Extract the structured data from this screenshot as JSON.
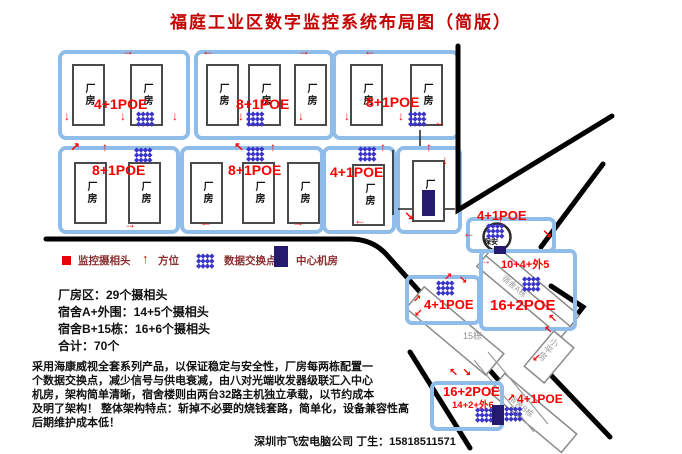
{
  "title": "福庭工业区数字监控系统布局图（简版）",
  "factory": {
    "building_label": "厂房",
    "blocks": [
      {
        "label": "4+1POE"
      },
      {
        "label": "8+1POE"
      },
      {
        "label": "8+1POE"
      },
      {
        "label": "8+1POE"
      },
      {
        "label": "8+1POE"
      },
      {
        "label": "4+1POE"
      }
    ]
  },
  "legend": {
    "camera": "监控摄相头",
    "direction": "方位",
    "switch": "数据交换点",
    "server_room": "中心机房"
  },
  "stats": {
    "lines": [
      "厂房区：29个摄相头",
      "宿舍A+外围：14+5个摄相头",
      "宿舍B+15栋：16+6个摄相头",
      "合计：70个"
    ]
  },
  "description": {
    "lines": [
      "采用海康威视全套系列产品，以保证稳定与安全性，厂房每两栋配置一",
      "个数据交换点，减少信号与供电衰减，由八对光端收发器级联汇入中心",
      "机房，架构简单清晰，宿舍楼则由两台32路主机独立承载，以节约成本",
      "及明了架构！ 整体架构特点：斩掉不必要的烧钱套路，简单化，设备兼容性高",
      "后期维护成本低！"
    ]
  },
  "contact": "深圳市飞宏电脑公司 丁生：15818511571",
  "site": {
    "security": {
      "poe": "4+1POE",
      "label": "保安"
    },
    "dorm_a": {
      "counts": "10+4+外5",
      "poe": "16+2POE",
      "label": "宿舍A栋"
    },
    "block15": {
      "poe": "4+1POE",
      "label": "15栋"
    },
    "dorm_b": {
      "poe": "16+2POE",
      "counts": "14+2+外6",
      "poe2": "4+1POE",
      "label": "宿舍B栋"
    },
    "bungalow": {
      "label": "小平房"
    }
  },
  "icons": {
    "diamond_row": "◆◆◆◆",
    "arrow_up": "↑",
    "arrow_down": "↓",
    "arrow_left": "←",
    "arrow_right": "→",
    "arrow_up_right": "↗",
    "arrow_down_right": "↘",
    "arrow_up_left": "↖",
    "arrow_down_left": "↙"
  },
  "colors": {
    "title_red": "#c40000",
    "poe_red": "#fb0000",
    "switch_blue": "#3a35c8",
    "box_blue": "#8fbce8",
    "room_navy": "#241a70",
    "legend_text": "#8b3030"
  }
}
